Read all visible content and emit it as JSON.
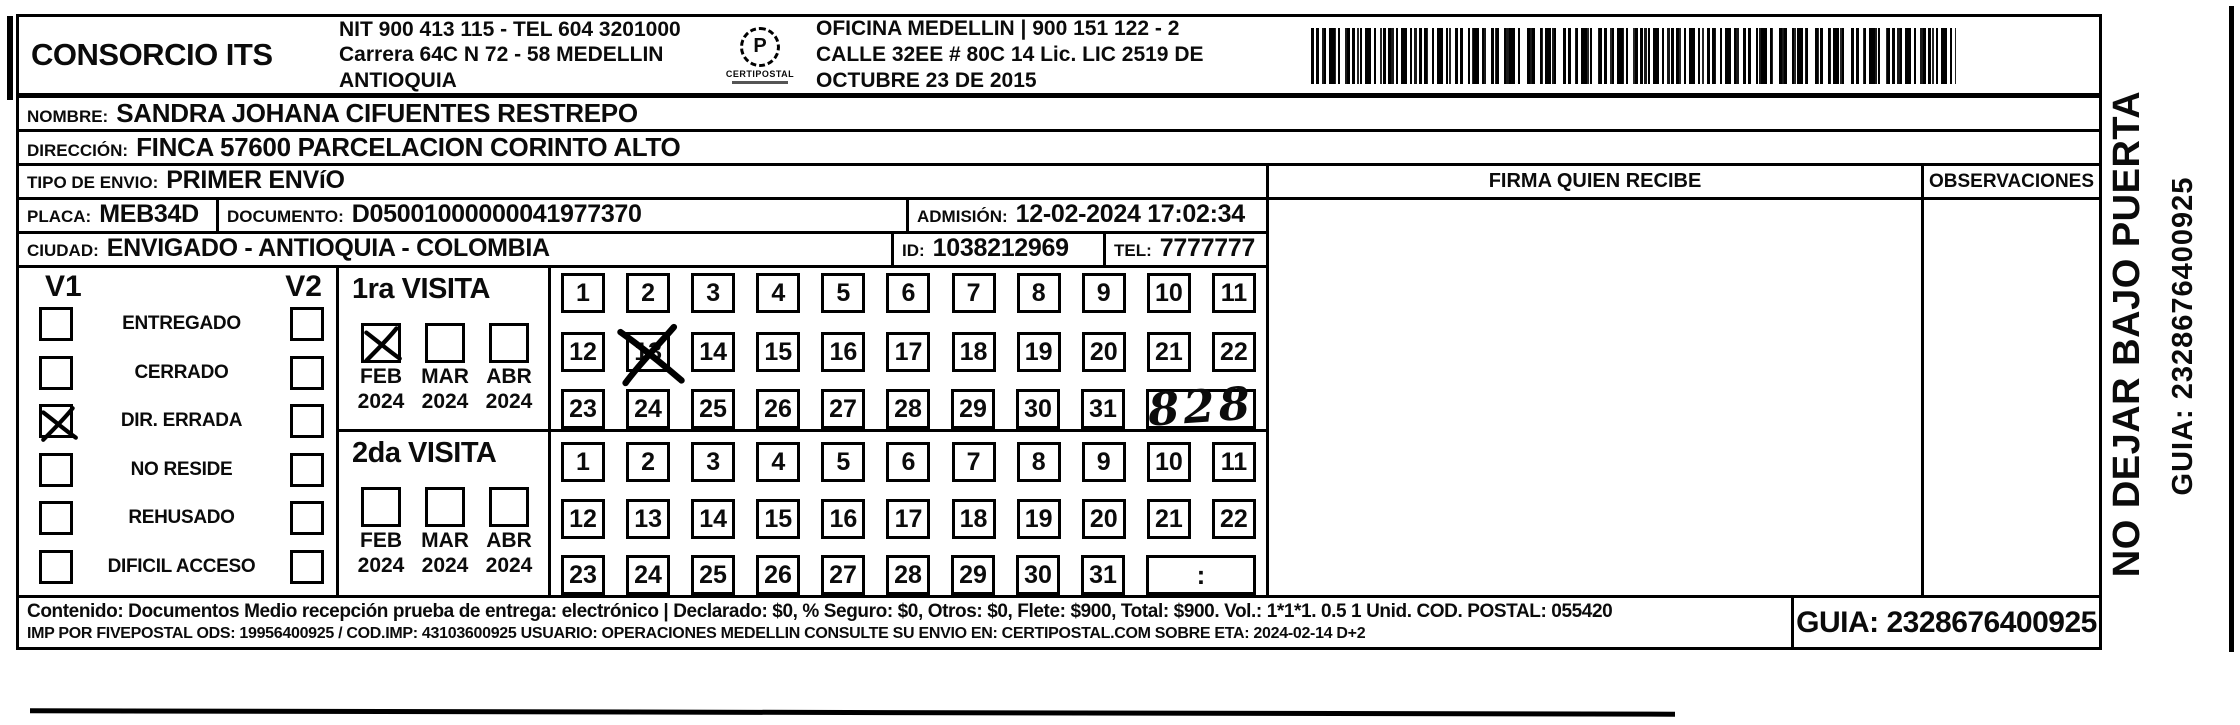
{
  "header": {
    "company": "CONSORCIO ITS",
    "nit_line1": "NIT 900 413 115 - TEL 604 3201000",
    "nit_line2": "Carrera 64C N 72 - 58 MEDELLIN ANTIOQUIA",
    "logo_letter": "P",
    "logo_text": "CERTIPOSTAL",
    "office_line1": "OFICINA MEDELLIN | 900 151 122 - 2",
    "office_line2": "CALLE 32EE # 80C 14 Lic. LIC 2519 DE OCTUBRE 23 DE 2015"
  },
  "recipient": {
    "nombre_label": "NOMBRE:",
    "nombre": "SANDRA JOHANA CIFUENTES RESTREPO",
    "direccion_label": "DIRECCIÓN:",
    "direccion": "FINCA 57600 PARCELACION CORINTO ALTO",
    "tipo_label": "TIPO DE ENVIO:",
    "tipo": "PRIMER ENVíO",
    "placa_label": "PLACA:",
    "placa": "MEB34D",
    "documento_label": "DOCUMENTO:",
    "documento": "D05001000000041977370",
    "admision_label": "ADMISIÓN:",
    "admision": "12-02-2024 17:02:34",
    "ciudad_label": "CIUDAD:",
    "ciudad": "ENVIGADO - ANTIOQUIA - COLOMBIA",
    "id_label": "ID:",
    "id_value": "1038212969",
    "tel_label": "TEL:",
    "tel": "7777777"
  },
  "status": {
    "col1": "V1",
    "col2": "V2",
    "items": [
      {
        "label": "ENTREGADO",
        "v1": false,
        "v2": false
      },
      {
        "label": "CERRADO",
        "v1": false,
        "v2": false
      },
      {
        "label": "DIR. ERRADA",
        "v1": true,
        "v2": false
      },
      {
        "label": "NO RESIDE",
        "v1": false,
        "v2": false
      },
      {
        "label": "REHUSADO",
        "v1": false,
        "v2": false
      },
      {
        "label": "DIFICIL ACCESO",
        "v1": false,
        "v2": false
      }
    ]
  },
  "visits": [
    {
      "title": "1ra VISITA",
      "months": [
        {
          "month": "FEB",
          "year": "2024",
          "checked": true
        },
        {
          "month": "MAR",
          "year": "2024",
          "checked": false
        },
        {
          "month": "ABR",
          "year": "2024",
          "checked": false
        }
      ],
      "day_rows": [
        [
          1,
          2,
          3,
          4,
          5,
          6,
          7,
          8,
          9,
          10,
          11
        ],
        [
          12,
          13,
          14,
          15,
          16,
          17,
          18,
          19,
          20,
          21,
          22
        ],
        [
          23,
          24,
          25,
          26,
          27,
          28,
          29,
          30,
          31
        ]
      ],
      "crossed_day": 13,
      "extra_box": "828",
      "extra_type": "handwritten"
    },
    {
      "title": "2da VISITA",
      "months": [
        {
          "month": "FEB",
          "year": "2024",
          "checked": false
        },
        {
          "month": "MAR",
          "year": "2024",
          "checked": false
        },
        {
          "month": "ABR",
          "year": "2024",
          "checked": false
        }
      ],
      "day_rows": [
        [
          1,
          2,
          3,
          4,
          5,
          6,
          7,
          8,
          9,
          10,
          11
        ],
        [
          12,
          13,
          14,
          15,
          16,
          17,
          18,
          19,
          20,
          21,
          22
        ],
        [
          23,
          24,
          25,
          26,
          27,
          28,
          29,
          30,
          31
        ]
      ],
      "crossed_day": null,
      "extra_box": ":",
      "extra_type": "time"
    }
  ],
  "right_panel": {
    "firma_label": "FIRMA QUIEN RECIBE",
    "observaciones_label": "OBSERVACIONES"
  },
  "footer": {
    "line1": "Contenido: Documentos Medio recepción prueba de entrega: electrónico | Declarado: $0, % Seguro: $0, Otros: $0, Flete: $900, Total: $900. Vol.: 1*1*1. 0.5  1 Unid. COD. POSTAL: 055420",
    "line2": "IMP POR FIVEPOSTAL ODS: 19956400925 / COD.IMP: 43103600925 USUARIO: OPERACIONES MEDELLIN CONSULTE SU ENVIO EN: CERTIPOSTAL.COM SOBRE ETA: 2024-02-14 D+2",
    "guia": "GUIA: 2328676400925"
  },
  "side": {
    "warning": "NO DEJAR BAJO PUERTA",
    "guia": "GUIA: 2328676400925"
  },
  "colors": {
    "ink": "#0b0b0b",
    "paper": "#ffffff"
  }
}
